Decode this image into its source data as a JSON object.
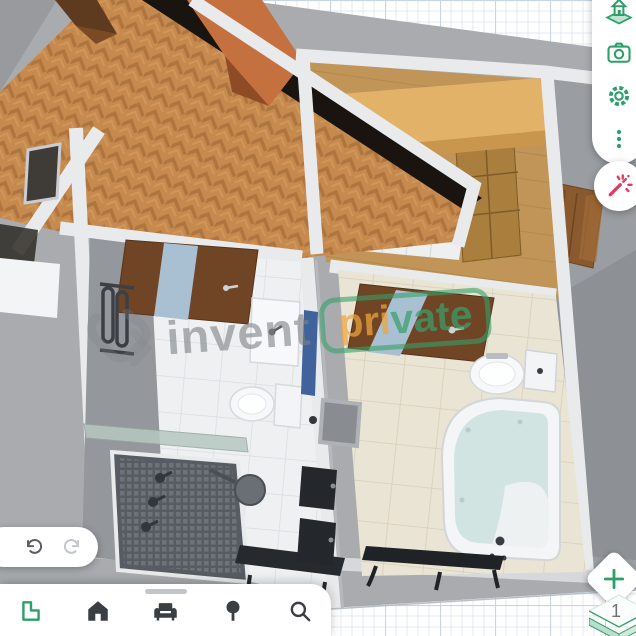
{
  "watermark": {
    "logo_icon": "invent-logo-icon",
    "left_text": "invent",
    "badge": {
      "part1": "pri",
      "part2": "vate"
    }
  },
  "right_toolbar": {
    "items": [
      {
        "icon": "house-3d-icon"
      },
      {
        "icon": "camera-icon"
      },
      {
        "icon": "settings-gear-icon"
      },
      {
        "icon": "more-dots-icon"
      }
    ],
    "magic_button": {
      "icon": "magic-wand-icon"
    }
  },
  "history_bar": {
    "undo_icon": "undo-icon",
    "redo_icon": "redo-icon"
  },
  "bottom_toolbar": {
    "handle_icon": "drag-handle",
    "items": [
      {
        "icon": "floorplan-icon",
        "active": true
      },
      {
        "icon": "home-icon",
        "active": false
      },
      {
        "icon": "furniture-sofa-icon",
        "active": false
      },
      {
        "icon": "tree-icon",
        "active": false
      },
      {
        "icon": "search-icon",
        "active": false
      }
    ]
  },
  "floor_controls": {
    "add_button_icon": "plus-icon",
    "level": "1"
  },
  "colors": {
    "accent_green": "#2d9f69",
    "wand_pink": "#e13a62",
    "badge_orange": "#f0a43c",
    "badge_green": "#38a06a",
    "watermark_gray": "#7e8286",
    "icon_dark": "#3b3e42"
  },
  "scene": {
    "view": "3d-floorplan",
    "rooms": [
      "hallway-herringbone",
      "dressing-room",
      "bathroom-left",
      "bathroom-right",
      "side-room"
    ],
    "objects": [
      "corner-bathtub",
      "toilet",
      "sink",
      "shower-tray",
      "shower-glass",
      "towel-radiator",
      "wood-door-with-glass",
      "wardrobe",
      "counter-with-drawers",
      "blue-runner",
      "wall-mirror",
      "black-wall-cabinets",
      "bench",
      "wall-window"
    ]
  }
}
